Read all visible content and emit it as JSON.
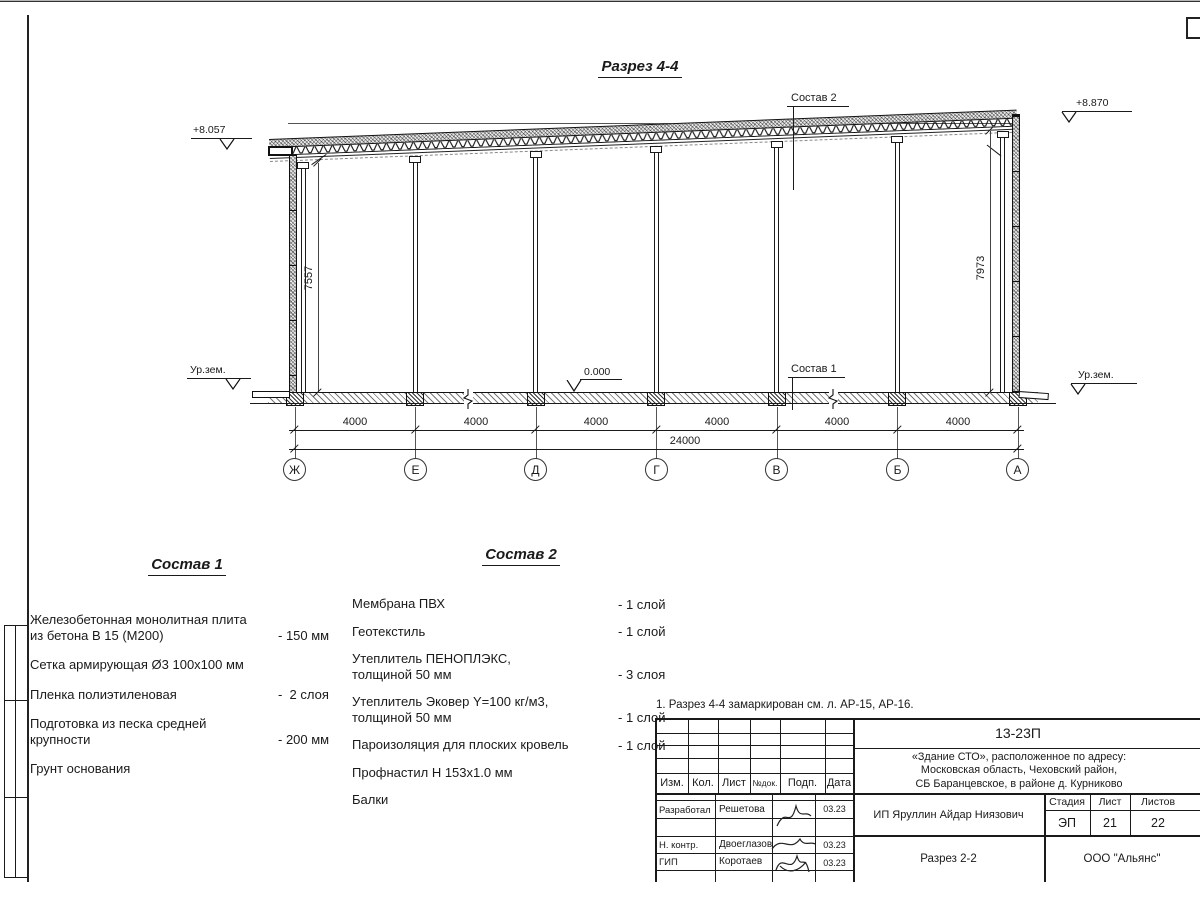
{
  "colors": {
    "line": "#1a1a1a",
    "hatch_grey": "#9a9a9a",
    "background": "#ffffff"
  },
  "section": {
    "title": "Разрез 4-4",
    "elev_left": "+8.057",
    "elev_right": "+8.870",
    "elev_zero": "0.000",
    "ground_left": "Ур.зем.",
    "ground_right": "Ур.зем.",
    "leader_top": "Состав 2",
    "leader_floor": "Состав 1",
    "dim_left": "7557",
    "dim_right": "7973",
    "bays": [
      "4000",
      "4000",
      "4000",
      "4000",
      "4000",
      "4000"
    ],
    "total": "24000",
    "axes": [
      "Ж",
      "Е",
      "Д",
      "Г",
      "В",
      "Б",
      "А"
    ]
  },
  "sostav1": {
    "heading": "Состав 1",
    "items": [
      {
        "text": "Железобетонная  монолитная плита\nиз бетона В 15 (М200)",
        "value": "- 150 мм"
      },
      {
        "text": "Сетка армирующая Ø3 100х100 мм",
        "value": ""
      },
      {
        "text": "Пленка полиэтиленовая",
        "value": "-  2 слоя"
      },
      {
        "text": "Подготовка из песка средней\nкрупности",
        "value": "- 200 мм"
      },
      {
        "text": "Грунт основания",
        "value": ""
      }
    ]
  },
  "sostav2": {
    "heading": "Состав 2",
    "items": [
      {
        "text": "Мембрана ПВХ",
        "value": "- 1 слой"
      },
      {
        "text": "Геотекстиль",
        "value": "- 1 слой"
      },
      {
        "text": "Утеплитель ПЕНОПЛЭКС,\nтолщиной 50 мм",
        "value": "- 3 слоя"
      },
      {
        "text": "Утеплитель Эковер Y=100 кг/м3,\nтолщиной 50 мм",
        "value": "- 1 слой"
      },
      {
        "text": "Пароизоляция для плоских кровель",
        "value": "- 1 слой"
      },
      {
        "text": "Профнастил Н 153х1.0 мм",
        "value": ""
      },
      {
        "text": "Балки",
        "value": ""
      }
    ]
  },
  "titleblock": {
    "note": "1. Разрез 4-4 замаркирован см. л. АР-15, АР-16.",
    "code": "13-23П",
    "address": "«Здание СТО», расположенное по адресу:\nМосковская область, Чеховский район,\nСБ Баранцевское, в районе д. Курниково",
    "cols": [
      "Изм.",
      "Кол.",
      "Лист",
      "№док.",
      "Подп.",
      "Дата"
    ],
    "rows": [
      {
        "role": "Разработал",
        "name": "Решетова",
        "date": "03.23"
      },
      {
        "role": "Н. контр.",
        "name": "Двоеглазов",
        "date": "03.23"
      },
      {
        "role": "ГИП",
        "name": "Коротаев",
        "date": "03.23"
      }
    ],
    "client": "ИП Яруллин Айдар Ниязович",
    "stage_label": "Стадия",
    "sheet_label": "Лист",
    "sheets_label": "Листов",
    "stage": "ЭП",
    "sheet": "21",
    "sheets": "22",
    "drawing_name": "Разрез 2-2",
    "company": "ООО \"Альянс\""
  }
}
